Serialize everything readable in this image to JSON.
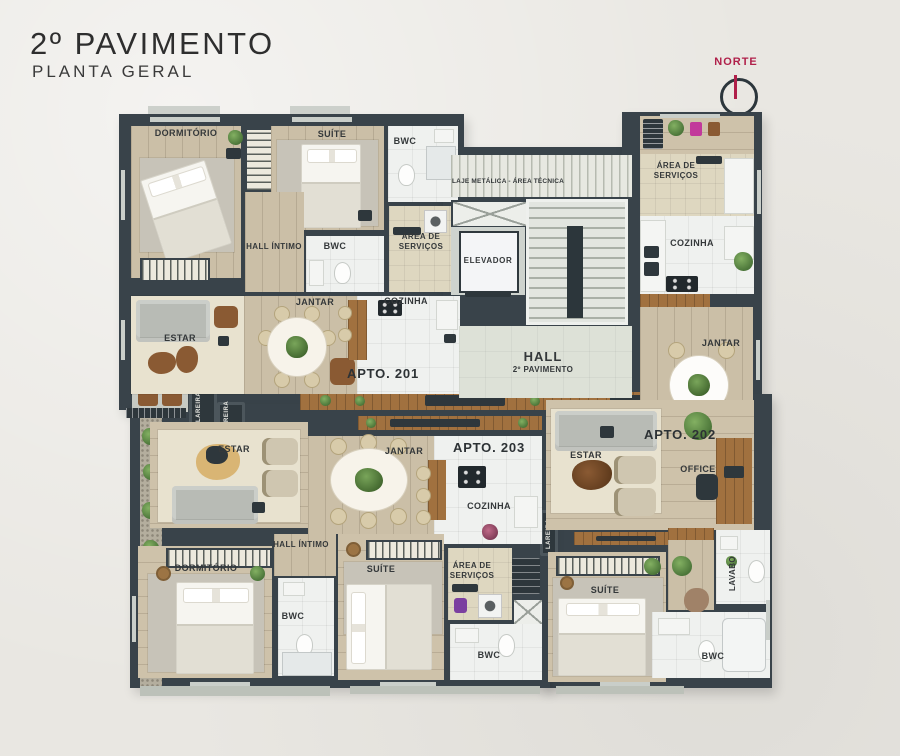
{
  "title": {
    "heading": "2º PAVIMENTO",
    "subheading": "PLANTA GERAL"
  },
  "north": {
    "label": "NORTE",
    "accent_color": "#b0204a"
  },
  "palette": {
    "wall": "#39434a",
    "background": "#e9e7e2",
    "wood": "#cbbfa7",
    "rug": "#e8e2cf"
  },
  "core": {
    "laje": "LAJE METÁLICA - ÁREA TÉCNICA",
    "elevador": "ELEVADOR",
    "hall": "HALL",
    "hall_sub": "2º PAVIMENTO"
  },
  "apt201": {
    "name": "APTO. 201",
    "dormitorio": "DORMITÓRIO",
    "suite": "SUÍTE",
    "bwc_suite": "BWC",
    "bwc_social": "BWC",
    "hall_intimo": "HALL ÍNTIMO",
    "area_servicos": "ÁREA DE SERVIÇOS",
    "cozinha": "COZINHA",
    "jantar": "JANTAR",
    "estar": "ESTAR",
    "lareira": "LAREIRA"
  },
  "apt202": {
    "name": "APTO. 202",
    "area_servicos": "ÁREA DE SERVIÇOS",
    "cozinha": "COZINHA",
    "jantar": "JANTAR",
    "estar": "ESTAR",
    "office": "OFFICE",
    "lareira": "LAREIRA",
    "suite": "SUÍTE",
    "lavabo": "LAVABO",
    "bwc": "BWC"
  },
  "apt203": {
    "name": "APTO. 203",
    "estar": "ESTAR",
    "jantar": "JANTAR",
    "cozinha": "COZINHA",
    "hall_intimo": "HALL ÍNTIMO",
    "dormitorio": "DORMITÓRIO",
    "bwc_hall": "BWC",
    "suite": "SUÍTE",
    "area_servicos": "ÁREA DE SERVIÇOS",
    "bwc_suite": "BWC",
    "lareira": "LAREIRA"
  }
}
